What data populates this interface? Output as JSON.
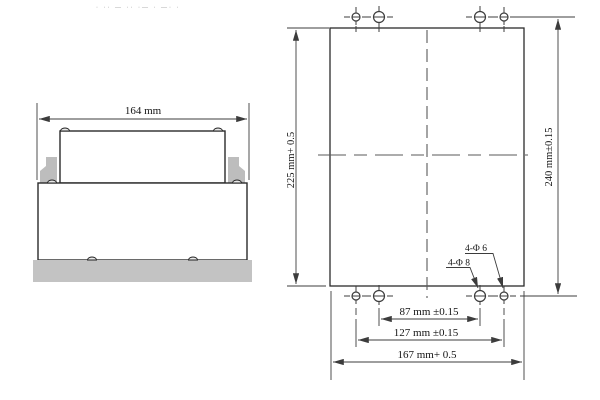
{
  "drawing": {
    "faint_header_marks": "· ·· — ·· ·— · —· ·",
    "side_view": {
      "bezel_width_label": "164 mm"
    },
    "cutout_view": {
      "cutout_height_label": "225 mm+ 0.5",
      "holes_vertical_span_label": "240 mm±0.15",
      "outer_holes_label": "4-Φ 6",
      "inner_holes_label": "4-Φ 8",
      "inner_holes_span_label": "87 mm ±0.15",
      "outer_holes_span_label": "127 mm ±0.15",
      "cutout_width_label": "167 mm+ 0.5"
    }
  }
}
